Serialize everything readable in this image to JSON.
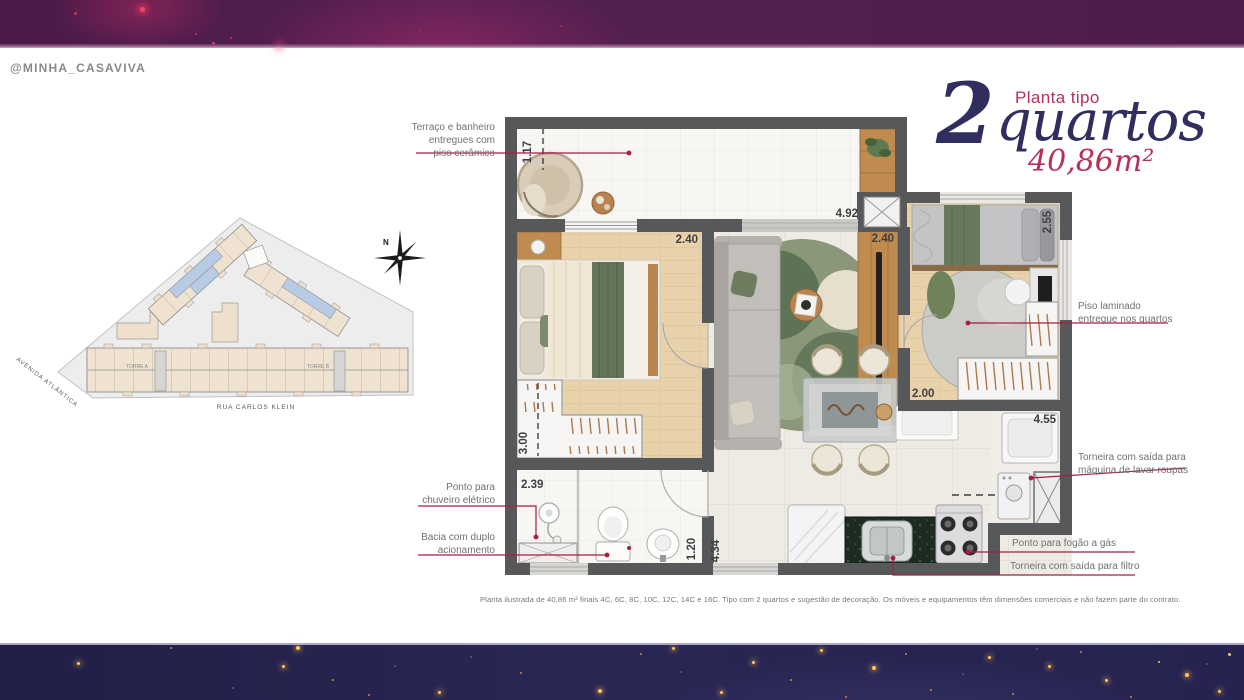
{
  "brand": {
    "handle": "@MINHA_CASAVIVA"
  },
  "title": {
    "kicker": "Planta tipo",
    "number": "2",
    "word": "quartos",
    "area": "40,86m²"
  },
  "site_plan": {
    "street_bottom": "RUA CARLOS KLEIN",
    "street_left": "AVENIDA ATLÂNTICA",
    "tower_a": "TORRE A",
    "tower_b": "TORRE B",
    "compass_north": "N"
  },
  "floor_plan": {
    "dimensions": {
      "terrace_width": "1.17",
      "living_length": "4.92",
      "bedroom1_width": "2.40",
      "living_width": "2.40",
      "bedroom2_depth": "2.55",
      "bedroom2_width": "2.00",
      "service_length": "4.55",
      "closet_depth": "3.00",
      "bathroom_width": "2.39",
      "hall_width": "1.20",
      "kitchen_depth": "4.34"
    }
  },
  "callouts": {
    "terrace": "Terraço e banheiro\nentregues com\npiso cerâmico",
    "shower": "Ponto para\nchuveiro elétrico",
    "toilet": "Bacia com duplo\nacionamento",
    "laminate": "Piso laminado\nentregue nos quartos",
    "washer": "Torneira  com saída para\nmáquina de lavar roupas",
    "stove": "Ponto para fogão a gás",
    "filter": "Torneira com saída para filtro"
  },
  "disclaimer": "Planta ilustrada de 40,86 m² finais 4C, 6C, 8C, 10C, 12C, 14C e 16C. Tipo com 2 quartos e sugestão de decoração. Os móveis e equipamentos têm dimensões comerciais e não fazem parte do contrato.",
  "colors": {
    "accent_red": "#a41e45",
    "title_navy": "#302e5f",
    "title_crimson": "#b53157",
    "header_purple": "#54204e",
    "footer_navy": "#262350",
    "star_gold": "#f2a93b",
    "wall_gray": "#57585a",
    "wood_floor": "#e8d2ac"
  }
}
